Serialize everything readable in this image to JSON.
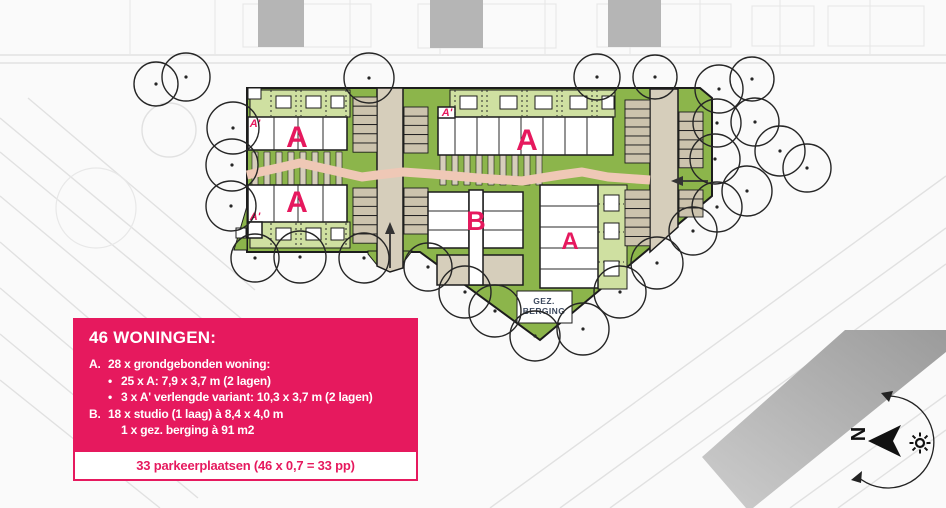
{
  "colors": {
    "accent": "#e6195e",
    "green": "#8cb54b",
    "light_green": "#cfe0a1",
    "road_beige": "#d6cebb",
    "path_pink": "#efc8b6",
    "existing_building_gray": "#b5b5b5"
  },
  "plan": {
    "labels": {
      "block_a_left_top": "A",
      "block_a_left_bottom": "A",
      "block_a_middle": "A",
      "block_a_right_bottom": "A",
      "block_b": "B",
      "a_prime_left_top": "A'",
      "a_prime_left_bottom": "A'",
      "a_prime_middle": "A'",
      "gez_berging_line1": "GEZ.",
      "gez_berging_line2": "BERGING"
    }
  },
  "legend": {
    "title": "46 WONINGEN:",
    "items": [
      {
        "prefix": "A.",
        "text": "28 x grondgebonden woning:"
      },
      {
        "prefix": "•",
        "text": "25 x A: 7,9 x 3,7 m (2 lagen)"
      },
      {
        "prefix": "•",
        "text": "3 x A' verlengde variant: 10,3 x 3,7 m (2 lagen)"
      },
      {
        "prefix": "B.",
        "text": "18 x studio  (1 laag) à 8,4 x 4,0 m"
      },
      {
        "prefix": "",
        "text": "1 x gez. berging à 91 m2"
      }
    ],
    "footer": "33 parkeerplaatsen (46 x 0,7 = 33 pp)"
  },
  "compass": {
    "north_label": "N"
  }
}
